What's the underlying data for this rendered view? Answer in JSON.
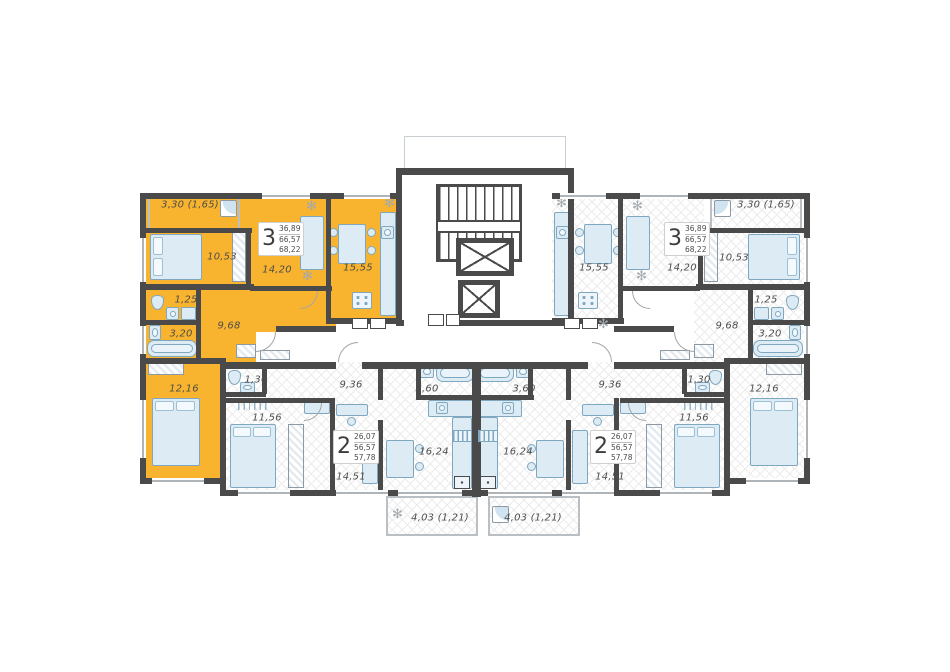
{
  "colors": {
    "highlight": "#f8b42e",
    "wall": "#4a4a4a",
    "furniture_fill": "#dcebf4",
    "furniture_stroke": "#7fa8c0",
    "hatch_line": "#ececec",
    "label_text": "#4c4c4c"
  },
  "icons": {
    "plant": "✻"
  },
  "apartments": {
    "left3": {
      "highlighted": true,
      "stamp": {
        "rooms": "3",
        "area_living": "36,89",
        "area_usable": "66,57",
        "area_total": "68,22"
      },
      "rooms": {
        "balcony": "3,30 (1,65)",
        "bedroom1": "10,53",
        "living": "14,20",
        "kitchen": "15,55",
        "wc": "1,25",
        "bath": "3,20",
        "hall": "9,68",
        "bedroom2": "12,16"
      }
    },
    "right3": {
      "highlighted": false,
      "stamp": {
        "rooms": "3",
        "area_living": "36,89",
        "area_usable": "66,57",
        "area_total": "68,22"
      },
      "rooms": {
        "balcony": "3,30 (1,65)",
        "bedroom1": "10,53",
        "living": "14,20",
        "kitchen": "15,55",
        "wc": "1,25",
        "bath": "3,20",
        "hall": "9,68",
        "bedroom2": "12,16"
      }
    },
    "left2": {
      "highlighted": false,
      "stamp": {
        "rooms": "2",
        "area_living": "26,07",
        "area_usable": "56,57",
        "area_total": "57,78"
      },
      "rooms": {
        "wc": "1,30",
        "hall": "9,36",
        "bedroom": "11,56",
        "living": "14,51",
        "kitchen": "16,24",
        "bath": "3,60",
        "balcony": "4,03 (1,21)"
      }
    },
    "right2": {
      "highlighted": false,
      "stamp": {
        "rooms": "2",
        "area_living": "26,07",
        "area_usable": "56,57",
        "area_total": "57,78"
      },
      "rooms": {
        "wc": "1,30",
        "hall": "9,36",
        "bedroom": "11,56",
        "living": "14,51",
        "kitchen": "16,24",
        "bath": "3,60",
        "balcony": "4,03 (1,21)"
      }
    }
  }
}
